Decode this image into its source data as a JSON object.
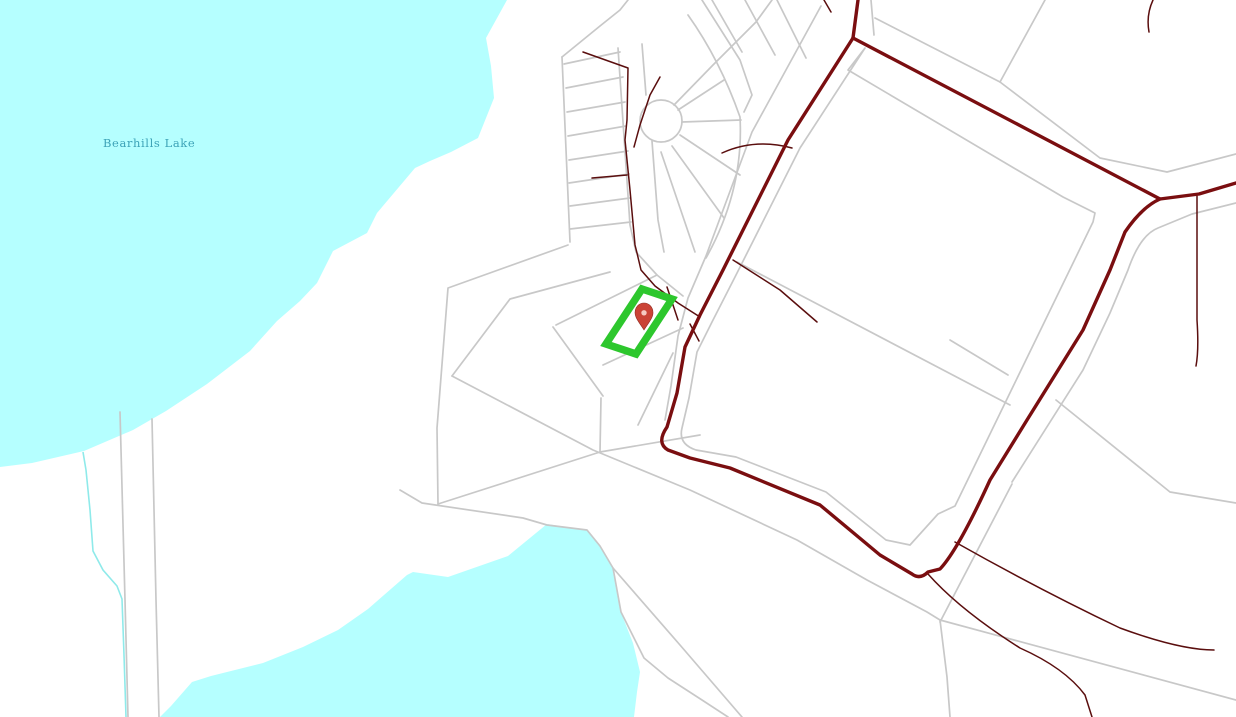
{
  "map": {
    "water_label": "Bearhills Lake",
    "marker": {
      "transform": "translate(644,316)"
    },
    "highlight": {
      "points": "642,289 672,299 636,354 606,344"
    }
  },
  "colors": {
    "bg": "#ffffff",
    "water": "#b5ffff",
    "water-stream": "#8feaea",
    "label": "#3da3b8",
    "parcel": "#c8c8c8",
    "road": "#7a0e10",
    "stream": "#5a0e0e",
    "highlight": "#2dc72d",
    "pin": "#ca4336",
    "pin-hole": "#f6cac2"
  }
}
